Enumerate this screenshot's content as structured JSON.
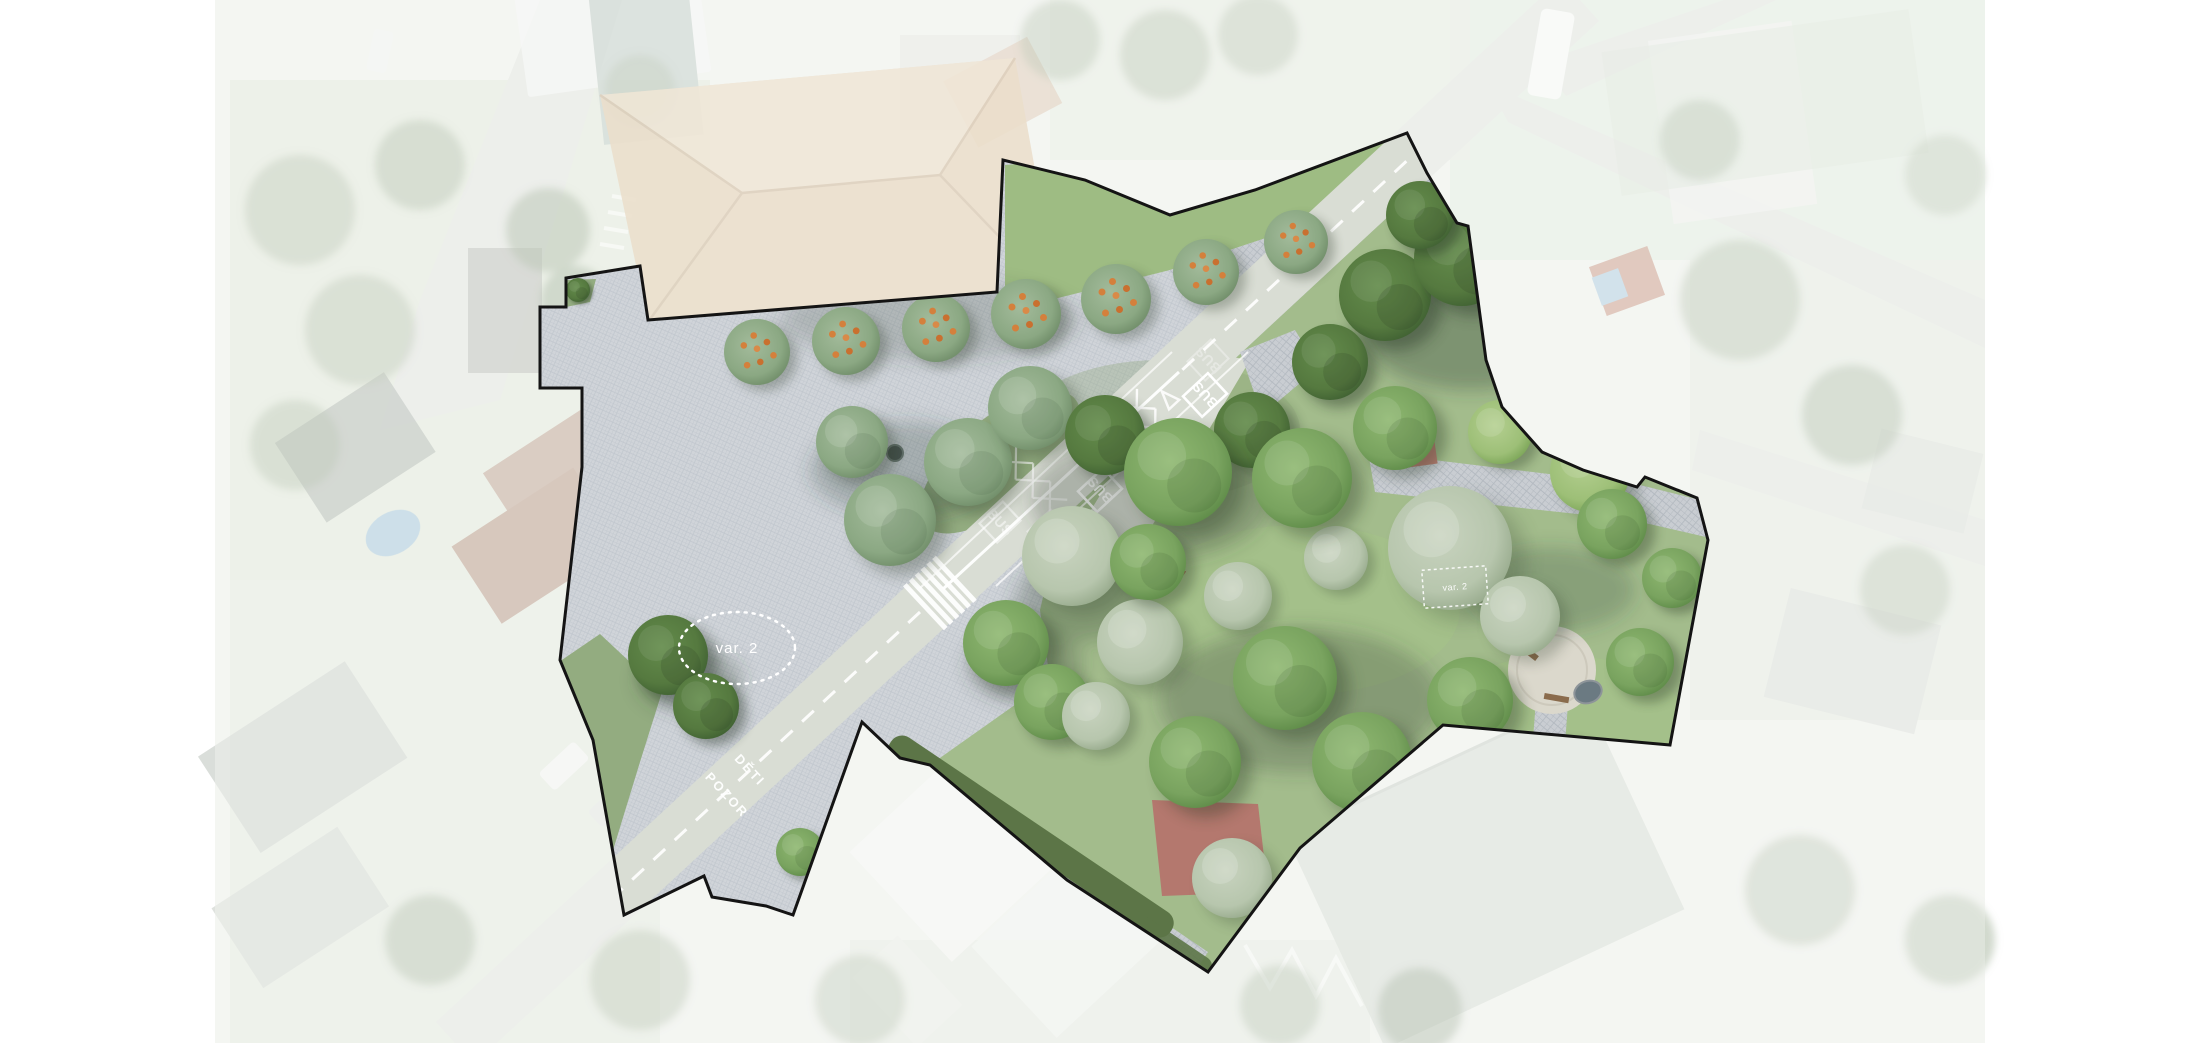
{
  "page": {
    "width": 2200,
    "height": 1043,
    "background": "#ffffff",
    "description": "Aerial-photo masterplan render: cobbled village square, diagonal main road with bus stop markings and pedestrian crossing, and a tree-filled park inside a black project boundary; surrounding aerial photo is washed out"
  },
  "plan": {
    "road": {
      "bus_label": "BUS",
      "pavement_warning_word1": "POZOR",
      "pavement_warning_word2": "DĚTI"
    },
    "annotations": {
      "variant_ellipse_label": "var. 2",
      "variant_box_label": "var. 2"
    },
    "colors": {
      "page_bg": "#ffffff",
      "aerial_base": "#ecefe9",
      "boundary": "#141414",
      "plaza_cobble": "#d0d4d9",
      "cobble_joint": "#c0c6cd",
      "path_cobble": "#c9cdd2",
      "road_asphalt": "#d9ddd4",
      "road_faded": "#e0e3dd",
      "park_grass": "#a3bc8c",
      "lawn_bright": "#9ebc83",
      "grass_muted": "#93ac80",
      "hedge": "#5c7547",
      "tree_green": "#79a35f",
      "tree_dark": "#55793f",
      "tree_sage": "#8ba883",
      "tree_pale": "#b7c6ad",
      "play_red": "#b5726b",
      "play_red2": "#bd8176",
      "roof_tan": "#dcc6a6",
      "pool_blue": "#9fc3d8",
      "marking": "#ffffff",
      "gravel": "#dbd8cc",
      "bench_brown": "#8a6b4c"
    }
  }
}
